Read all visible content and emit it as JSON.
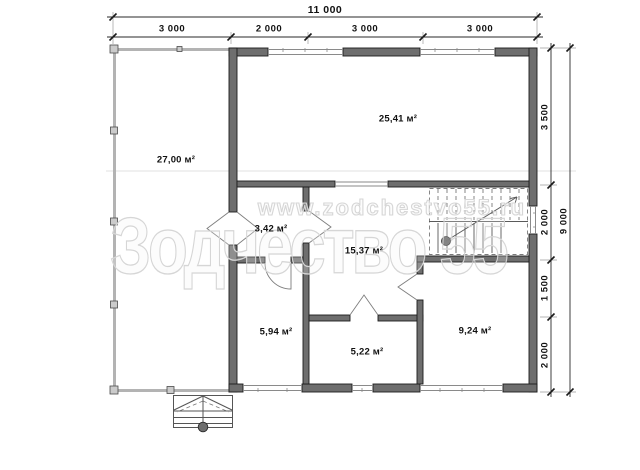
{
  "drawing": {
    "rooms": [
      {
        "name": "terrace",
        "area": "27,00 м²"
      },
      {
        "name": "living-room",
        "area": "25,41 м²"
      },
      {
        "name": "entry-hall",
        "area": "3,42 м²"
      },
      {
        "name": "hallway",
        "area": "15,37 м²"
      },
      {
        "name": "room-left",
        "area": "5,94 м²"
      },
      {
        "name": "room-center",
        "area": "5,22 м²"
      },
      {
        "name": "room-right",
        "area": "9,24 м²"
      }
    ],
    "dims": {
      "top_total": "11 000",
      "top_segments": [
        "3 000",
        "2 000",
        "3 000",
        "3 000"
      ],
      "right_total": "9 000",
      "right_segments": [
        "3 500",
        "2 000",
        "1 500",
        "2 000"
      ]
    },
    "watermark": {
      "url": "www.zodchestvo55.ru",
      "brand": "Зодчество 55"
    },
    "colors": {
      "wall_fill": "#6e6e6e",
      "wall_outline": "#1c1c1c",
      "terrace_wall": "#b3b3b3",
      "watermark": "#d6d6d6",
      "dimension_text": "#111111"
    }
  }
}
